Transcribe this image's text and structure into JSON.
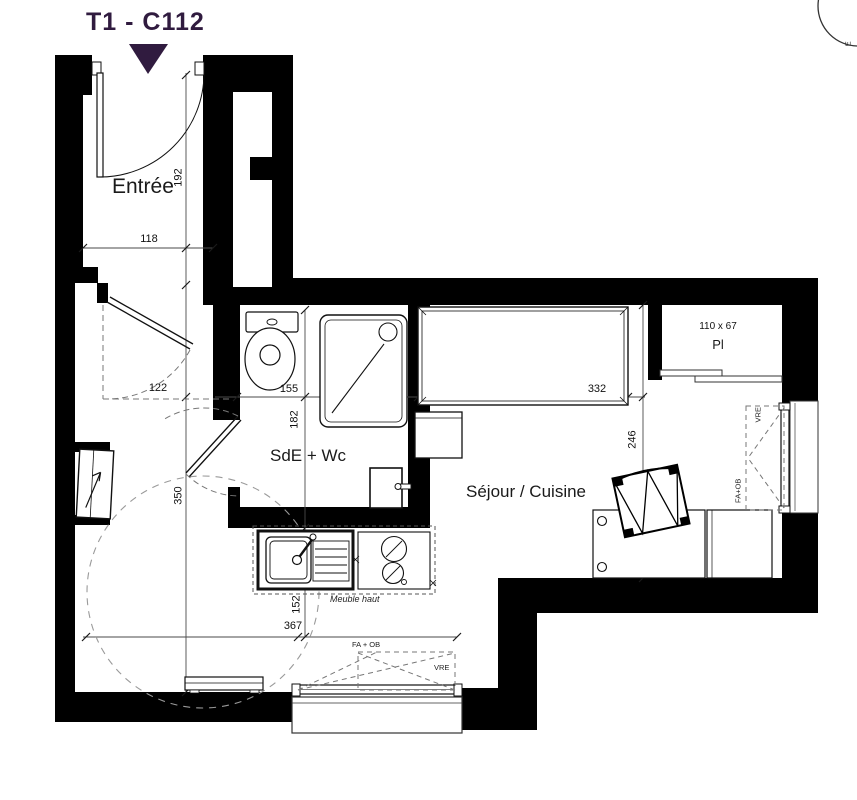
{
  "header": {
    "title": "T1 - C112"
  },
  "colors": {
    "accent": "#301b3f",
    "line": "#000000",
    "dashed_grey": "#8f8f8f"
  },
  "rooms": {
    "entree": {
      "label": "Entrée"
    },
    "bathroom": {
      "label": "SdE + Wc"
    },
    "living": {
      "label": "Séjour / Cuisine"
    },
    "closet": {
      "label": "Pl",
      "size": "110 x 67"
    }
  },
  "dimensions": {
    "entree_depth": "192",
    "entree_width": "118",
    "hall_clearance": "122",
    "bathroom_width": "155",
    "bathroom_depth": "182",
    "bed_length": "332",
    "living_depth": "246",
    "left_height": "350",
    "kitchen_depth": "152",
    "bottom_width": "367"
  },
  "annotations": {
    "kitchen_upper_cabinet": "Meuble haut",
    "corner_mark": "E",
    "window_right": {
      "top": "VRE",
      "bottom": "FA+OB"
    },
    "window_bottom": {
      "left": "FA + OB",
      "right": "VRE"
    }
  }
}
